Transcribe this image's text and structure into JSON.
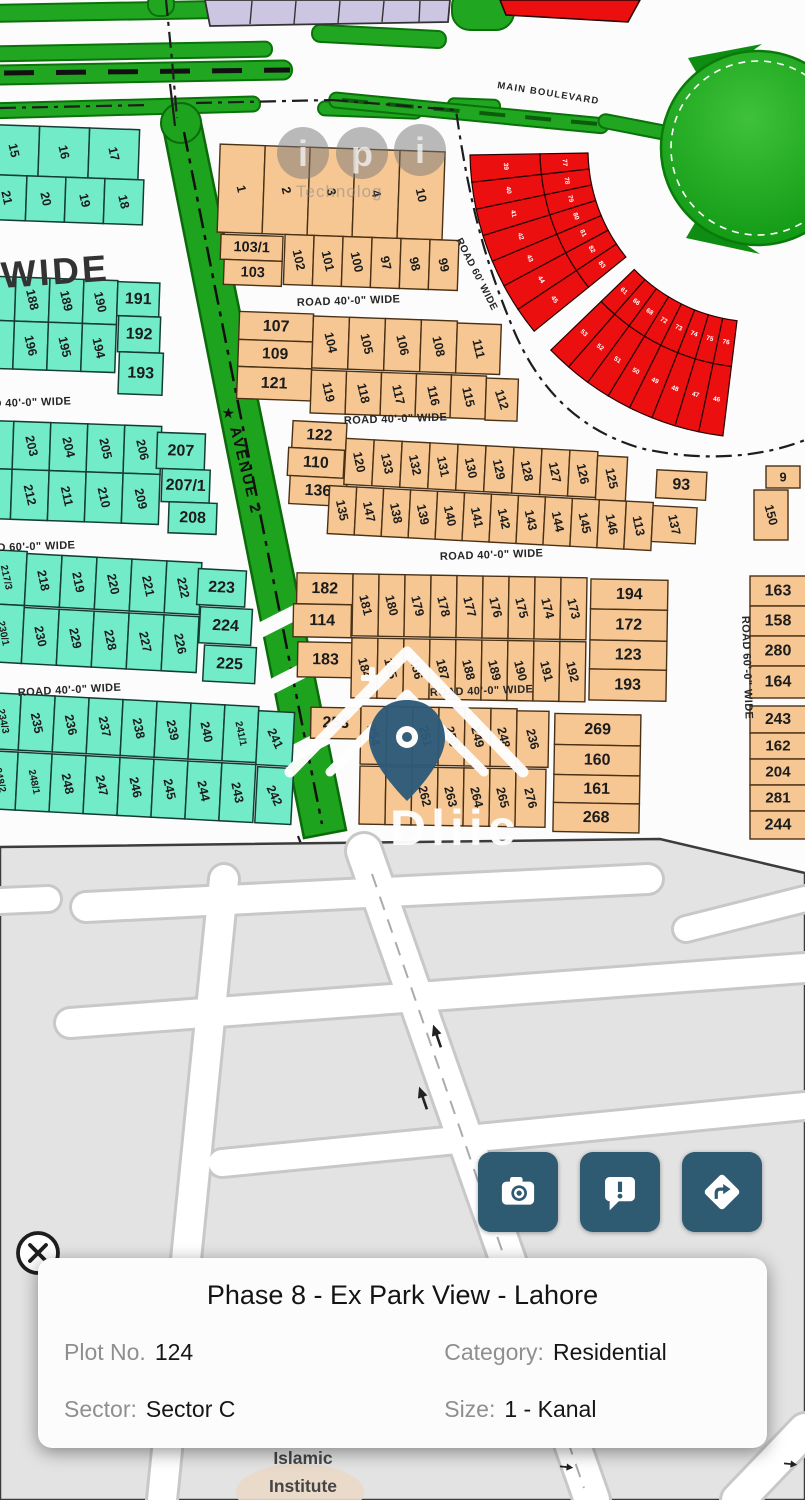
{
  "card": {
    "title": "Phase 8 - Ex Park View - Lahore",
    "fields": [
      {
        "label": "Plot No.",
        "value": "124"
      },
      {
        "label": "Category:",
        "value": "Residential"
      },
      {
        "label": "Sector:",
        "value": "Sector C"
      },
      {
        "label": "Size:",
        "value": "1 - Kanal"
      }
    ]
  },
  "fab_buttons": [
    {
      "icon": "camera-icon"
    },
    {
      "icon": "report-icon"
    },
    {
      "icon": "directions-icon"
    }
  ],
  "close_icon": "close-icon",
  "map": {
    "road_labels": {
      "wide_big": "WIDE",
      "main_boulevard": "MAIN BOULEVARD",
      "r40": "ROAD 40'-0\" WIDE",
      "r60": "ROAD 60'-0\" WIDE",
      "r30": "ROAD 30'-0\" WIDE",
      "r60_short": "ROAD 60' WIDE",
      "avenue": "AVENUE 2",
      "star": "★"
    },
    "watermarks": {
      "letters": [
        "i",
        "p",
        "i"
      ],
      "tech_text": "Technolog",
      "house_text": "Dliic"
    },
    "street_map": {
      "poi_line1": "Islamic",
      "poi_line2": "Institute"
    },
    "blocks": {
      "teal_a": [
        [
          "15",
          "16",
          "17"
        ],
        [
          "21",
          "20",
          "19",
          "18"
        ]
      ],
      "teal_b": [
        [
          "188",
          "189",
          "190"
        ],
        [
          "191"
        ],
        [
          "192"
        ],
        [
          "196",
          "195",
          "194"
        ],
        [
          "193"
        ]
      ],
      "teal_c": [
        [
          "203",
          "204",
          "205",
          "206"
        ],
        [
          "207"
        ],
        [
          "207/1"
        ],
        [
          "208"
        ],
        [
          "212",
          "211",
          "210",
          "209"
        ]
      ],
      "teal_d": [
        [
          "217/3"
        ],
        [
          "218",
          "219",
          "220",
          "221",
          "222"
        ],
        [
          "223"
        ],
        [
          "230/1"
        ],
        [
          "230",
          "229",
          "228",
          "227",
          "226"
        ],
        [
          "224"
        ],
        [
          "225"
        ]
      ],
      "teal_e": [
        [
          "234/3",
          "235",
          "236",
          "237",
          "238",
          "239",
          "240",
          "241/1"
        ],
        [
          "241"
        ],
        [
          "248/2",
          "248/1",
          "248",
          "247",
          "246",
          "245",
          "244",
          "243"
        ],
        [
          "242"
        ]
      ],
      "orange_f": [
        [
          "1",
          "2",
          "3",
          "4",
          "10"
        ],
        [
          "103/1"
        ],
        [
          "103"
        ],
        [
          "102",
          "101",
          "100",
          "97",
          "98",
          "99"
        ]
      ],
      "orange_g": [
        [
          "107"
        ],
        [
          "109"
        ],
        [
          "121"
        ],
        [
          "104",
          "105",
          "106",
          "108"
        ],
        [
          "111"
        ],
        [
          "119",
          "118",
          "117",
          "116",
          "115"
        ],
        [
          "112"
        ]
      ],
      "orange_h": [
        [
          "122"
        ],
        [
          "110"
        ],
        [
          "136"
        ],
        [
          "120",
          "133",
          "132",
          "131",
          "130",
          "129",
          "128",
          "127",
          "126"
        ],
        [
          "125"
        ],
        [
          "93"
        ],
        [
          "135",
          "147",
          "138",
          "139",
          "140",
          "141",
          "142",
          "143",
          "144",
          "145",
          "146",
          "113"
        ],
        [
          "137"
        ]
      ],
      "orange_h2": [
        [
          "9"
        ],
        [
          "150"
        ]
      ],
      "orange_i": [
        [
          "182"
        ],
        [
          "114"
        ],
        [
          "183"
        ],
        [
          "181",
          "180",
          "179",
          "178",
          "177",
          "176",
          "175",
          "174",
          "173"
        ],
        [
          "194"
        ],
        [
          "172"
        ],
        [
          "123"
        ],
        [
          "193"
        ],
        [
          "184",
          "185",
          "186",
          "187",
          "188",
          "189",
          "190",
          "191",
          "192"
        ]
      ],
      "orange_j": [
        [
          "253"
        ],
        [
          "254",
          "",
          "251",
          "250",
          "249",
          "248"
        ],
        [
          "236"
        ],
        [
          "269"
        ],
        [
          "160"
        ],
        [
          "161"
        ],
        [
          "268"
        ],
        [
          "",
          "",
          "262",
          "263",
          "264",
          "265"
        ],
        [
          "276"
        ]
      ],
      "orange_rc1": [
        [
          "163"
        ],
        [
          "158"
        ],
        [
          "280"
        ],
        [
          "164"
        ]
      ],
      "orange_rc2": [
        [
          "243"
        ],
        [
          "162"
        ],
        [
          "204"
        ],
        [
          "281"
        ],
        [
          "244"
        ]
      ]
    },
    "red_arcs": {
      "upper_outer": [
        "45",
        "44",
        "43",
        "42",
        "41",
        "40",
        "39"
      ],
      "upper_inner": [
        "83",
        "82",
        "81",
        "80",
        "79",
        "78",
        "77"
      ],
      "lower_outer": [
        "46",
        "47",
        "48",
        "49",
        "50",
        "51",
        "52",
        "53"
      ],
      "lower_inner": [
        "76",
        "75",
        "74",
        "73",
        "72",
        "68",
        "66",
        "61"
      ]
    }
  },
  "colors": {
    "accent_button": "#2e5a72",
    "teal_plot": "#72ecc8",
    "orange_plot": "#f6c793",
    "red_plot": "#ec0f0f",
    "green_belt": "#21a621"
  }
}
